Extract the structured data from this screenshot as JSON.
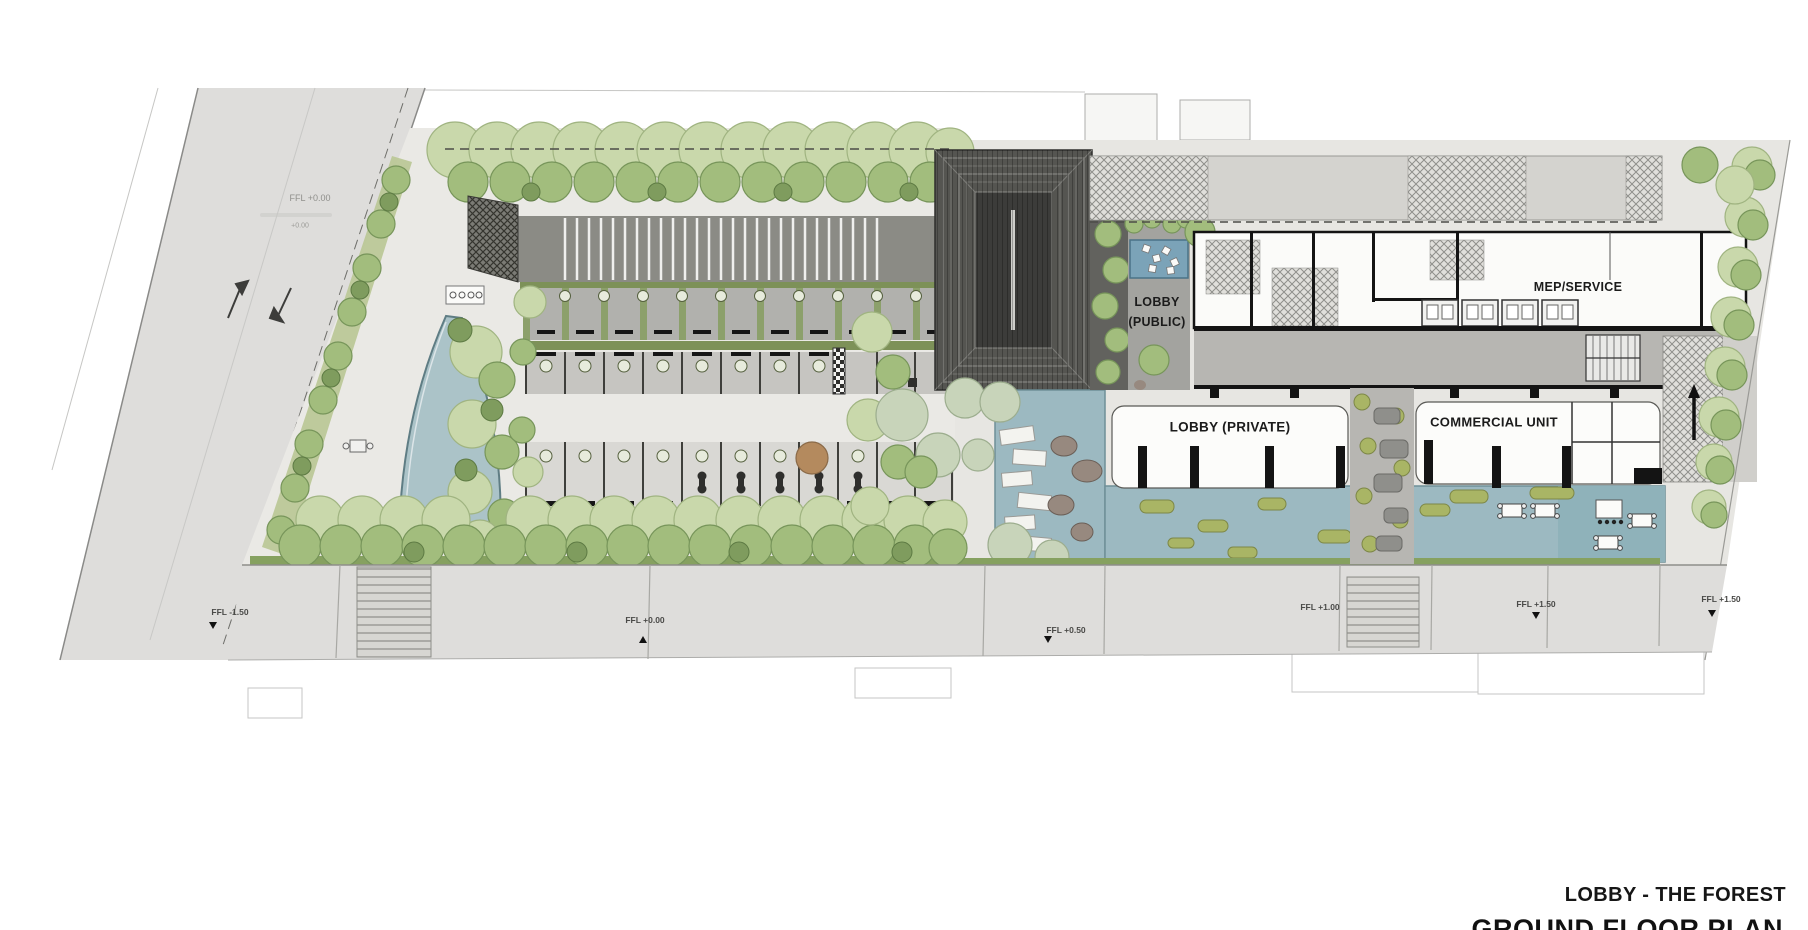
{
  "plan": {
    "rooms": {
      "lobby_public_line1": "LOBBY",
      "lobby_public_line2": "(PUBLIC)",
      "mep_service": "MEP/SERVICE",
      "lobby_private": "LOBBY (PRIVATE)",
      "commercial_unit": "COMMERCIAL UNIT"
    },
    "levels": [
      {
        "text": "FFL -1.50"
      },
      {
        "text": "FFL +0.00"
      },
      {
        "text": "FFL +0.50"
      },
      {
        "text": "FFL +1.00"
      },
      {
        "text": "FFL +1.50"
      },
      {
        "text": "FFL +1.50"
      }
    ],
    "road": {
      "level_label": "FFL +0.00",
      "note": "+0.00"
    },
    "titles": {
      "project": "LOBBY - THE FOREST",
      "sheet": "GROUND FLOOR PLAN"
    },
    "colors": {
      "water": "#9cb9c1",
      "tree_light": "#c9d8ab",
      "tree_mid": "#a2bd7d",
      "hedge": "#86a160",
      "pavilion_roof": "#555551",
      "wall": "#141414",
      "paving": "#eae9e5",
      "sidewalk": "#dedddb"
    }
  }
}
